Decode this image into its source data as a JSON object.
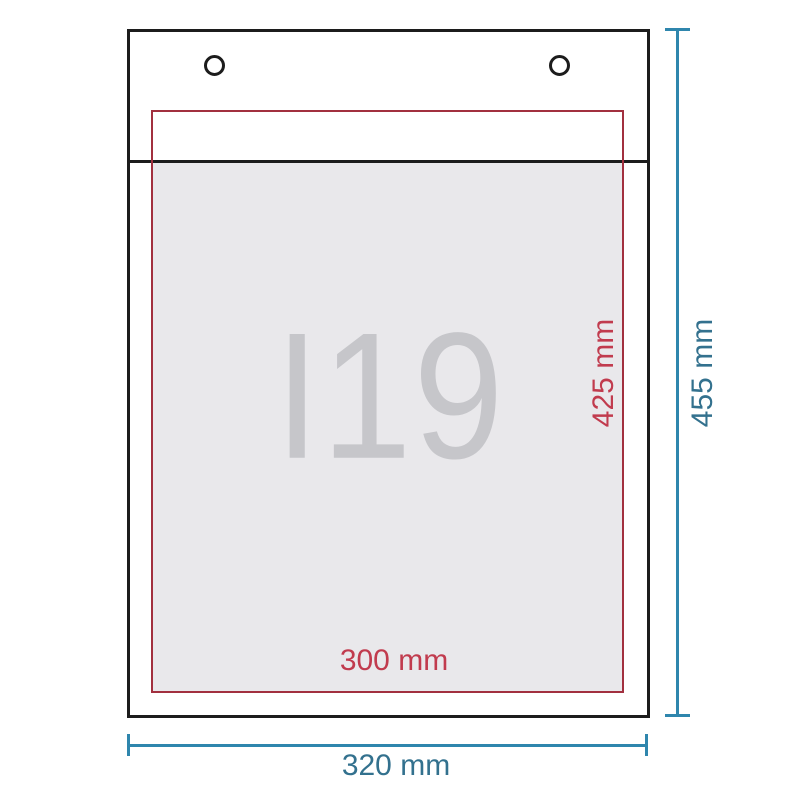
{
  "diagram": {
    "size_code": "I19",
    "inner": {
      "width_label": "300 mm",
      "height_label": "425 mm"
    },
    "outer": {
      "width_label": "320 mm",
      "height_label": "455 mm"
    },
    "colors": {
      "outline": "#1c1c1c",
      "inner_area_border": "#a2303f",
      "inner_dim_text": "#c13b4e",
      "outer_dim_line": "#2f86ad",
      "outer_dim_text": "#33718e",
      "area_fill": "#e9e8eb",
      "size_code_text": "#c6c6ca"
    }
  }
}
